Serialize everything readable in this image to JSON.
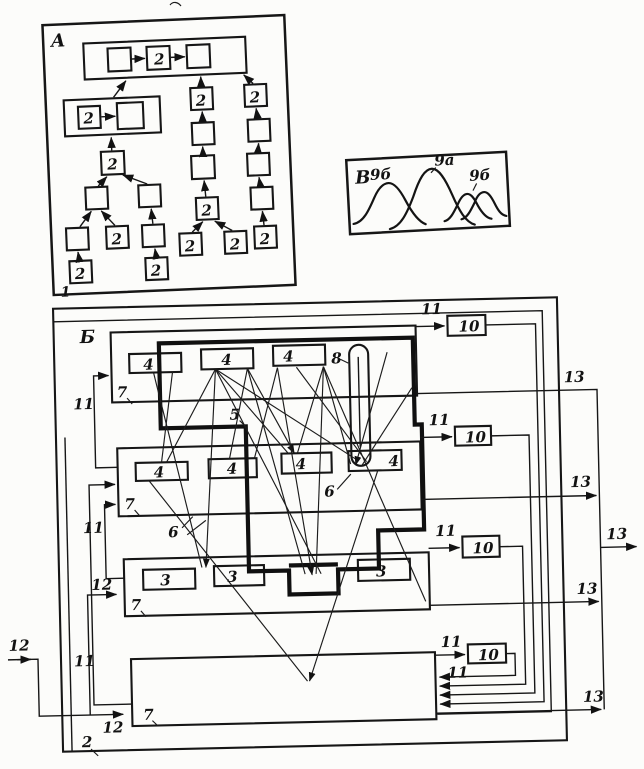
{
  "figure": {
    "panel_a": {
      "title": "A",
      "ref_num": "1",
      "node_label": "2"
    },
    "panel_v": {
      "title": "В",
      "peak_left": "9б",
      "peak_main": "9а",
      "peak_right": "9б"
    },
    "panel_b": {
      "title": "Б",
      "ref_num": "2",
      "row_label": "7",
      "unit4_label": "4",
      "unit3_label": "3",
      "sensor_label": "8",
      "contour_label": "5",
      "link_label": "6",
      "counter_label": "10",
      "bus11_label": "11",
      "bus12_label": "12",
      "bus13_label": "13"
    }
  }
}
